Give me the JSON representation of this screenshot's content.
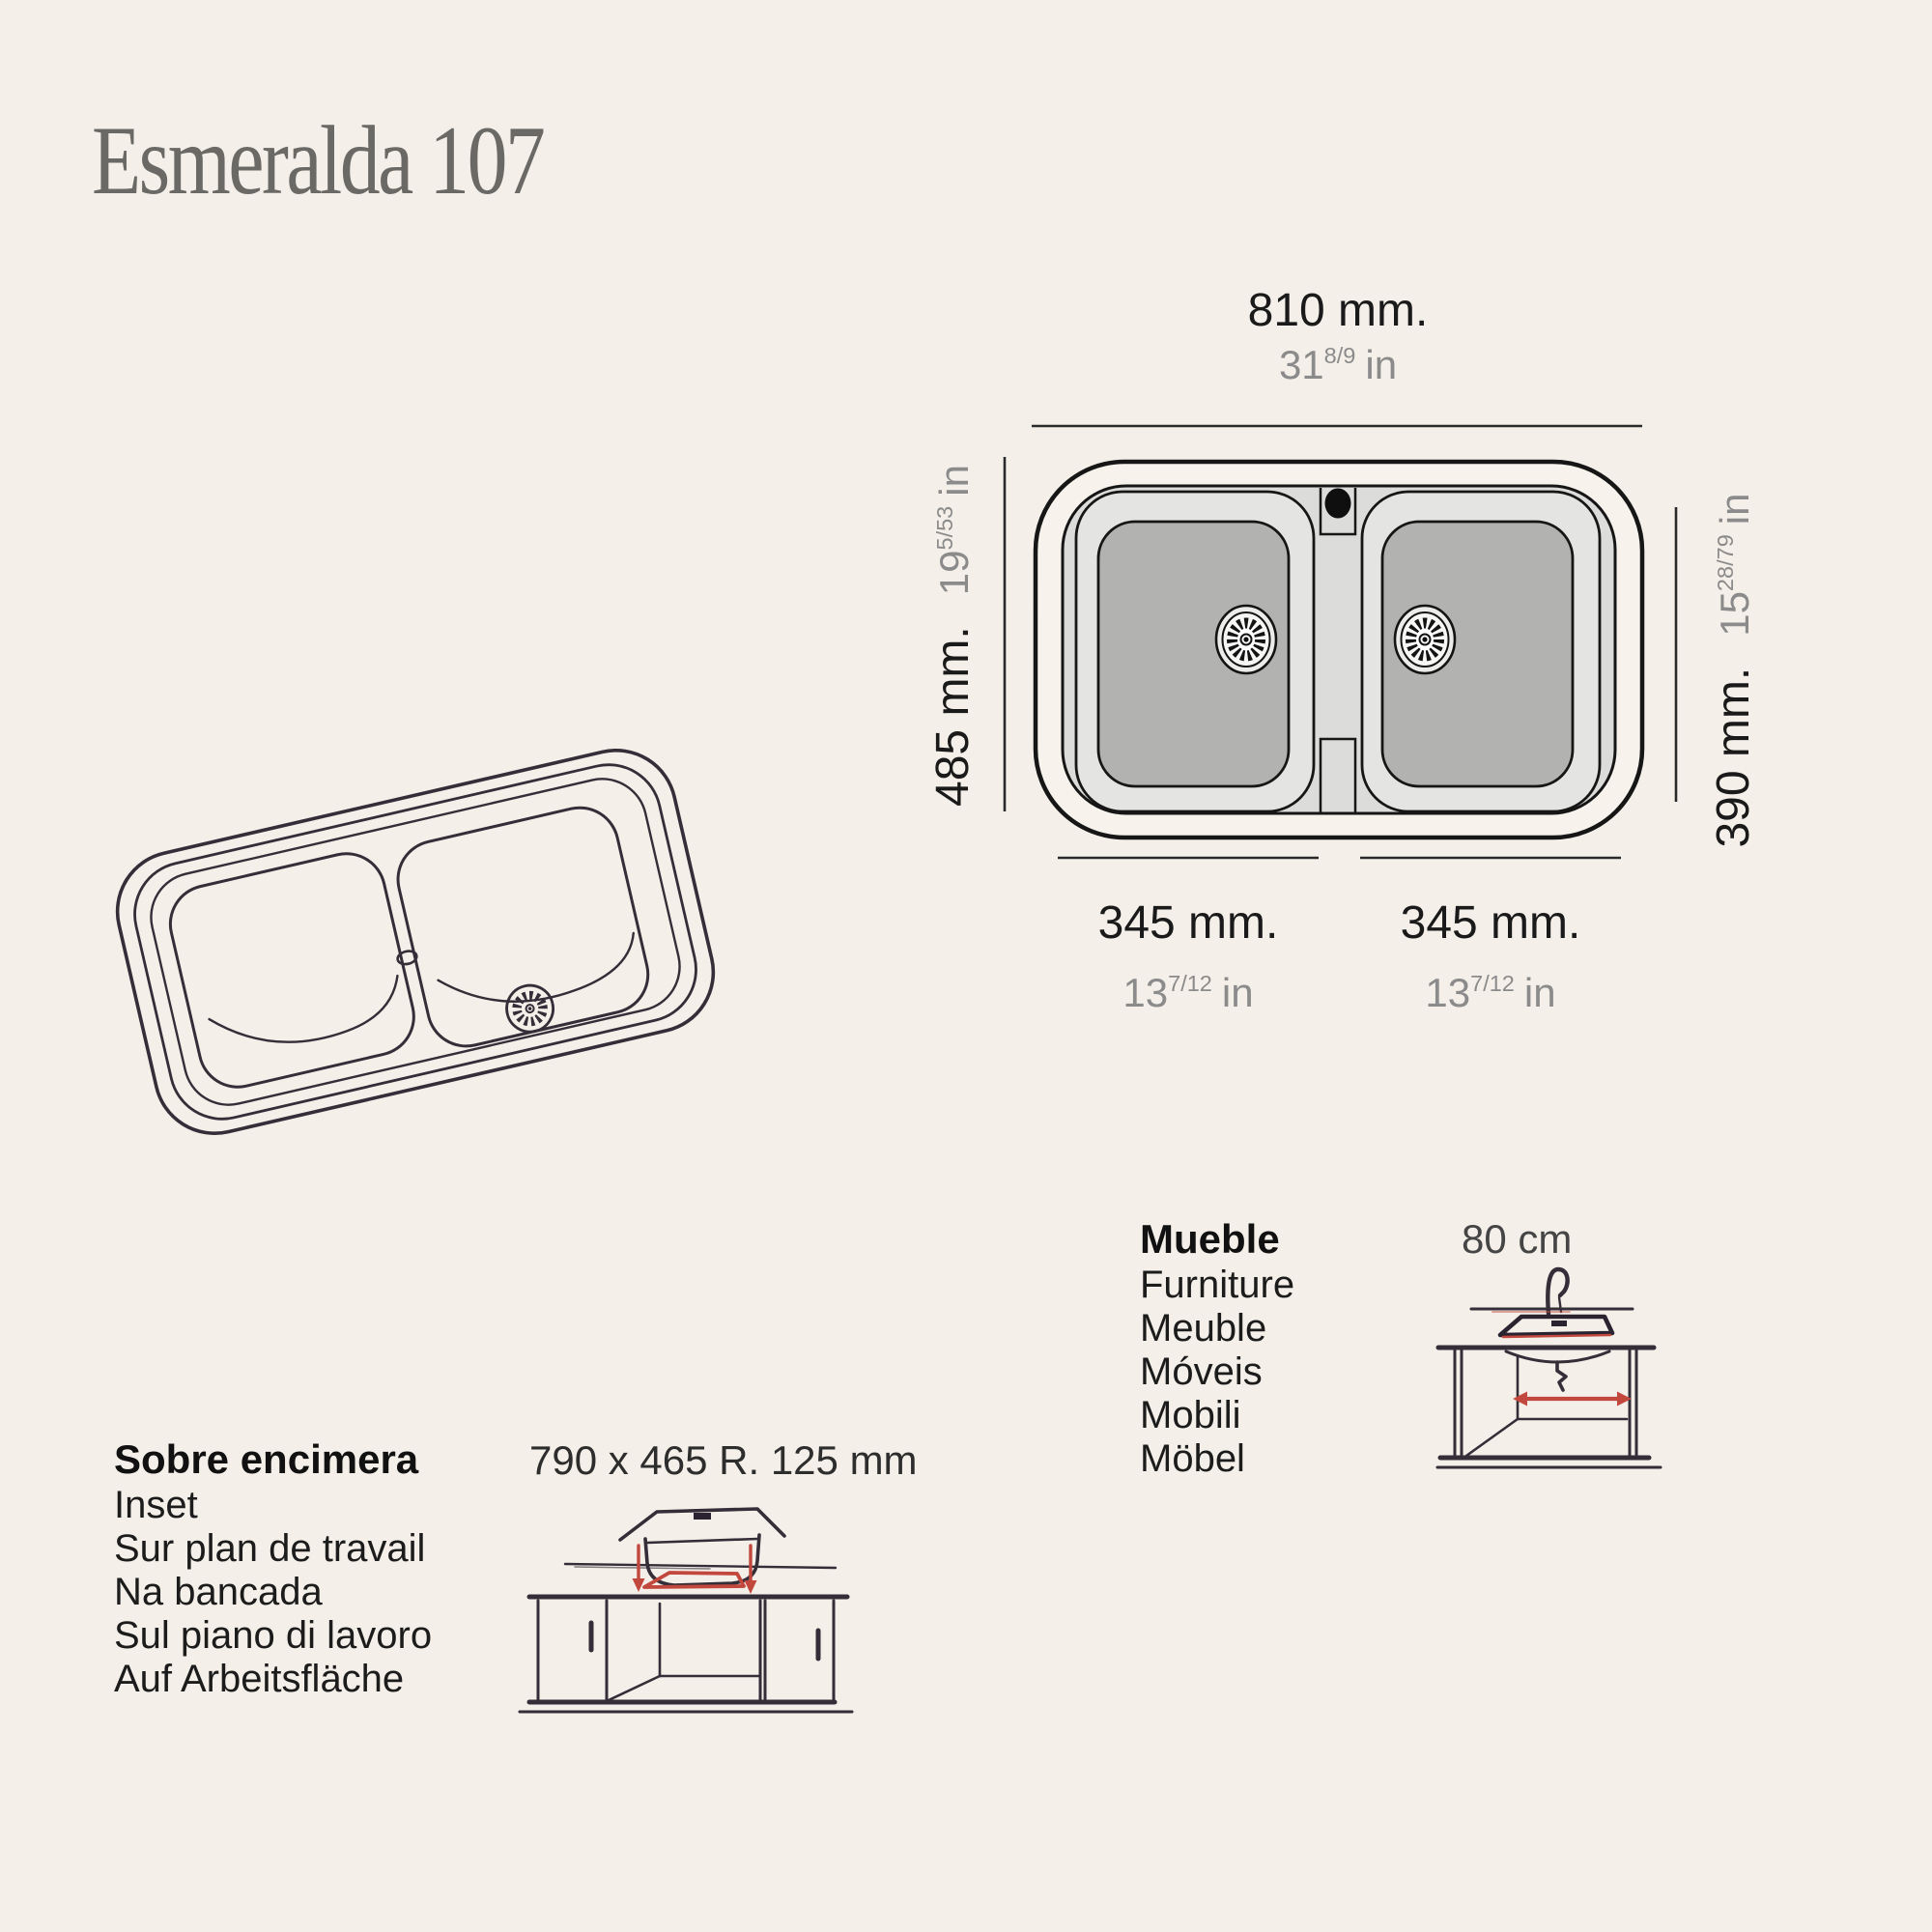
{
  "title": "Esmeralda 107",
  "dimensions": {
    "overall_width": {
      "mm": "810 mm.",
      "inches_int": "31",
      "inches_frac": "8/9",
      "inches_unit": "in"
    },
    "overall_depth": {
      "mm": "485 mm.",
      "inches_int": "19",
      "inches_frac": "5/53",
      "inches_unit": "in"
    },
    "bowl_depth": {
      "mm": "390 mm.",
      "inches_int": "15",
      "inches_frac": "28/79",
      "inches_unit": "in"
    },
    "left_bowl_width": {
      "mm": "345 mm.",
      "inches_int": "13",
      "inches_frac": "7/12",
      "inches_unit": "in"
    },
    "right_bowl_width": {
      "mm": "345 mm.",
      "inches_int": "13",
      "inches_frac": "7/12",
      "inches_unit": "in"
    }
  },
  "inset_installation": {
    "heading": "Sobre encimera",
    "translations": [
      "Inset",
      "Sur plan de travail",
      "Na bancada",
      "Sul piano di lavoro",
      "Auf Arbeitsfläche"
    ],
    "cutout_dimension": "790 x 465 R. 125 mm"
  },
  "furniture": {
    "heading": "Mueble",
    "translations": [
      "Furniture",
      "Meuble",
      "Móveis",
      "Mobili",
      "Möbel"
    ],
    "min_cabinet_width": "80 cm"
  },
  "colors": {
    "background": "#f4efe8",
    "ink": "#1a1a1a",
    "secondary_text": "#8b8b8b",
    "title_gray": "#6b6965",
    "sketch_ink": "#332e38",
    "accent_red": "#c2473c",
    "deck_gray": "#dcdcda",
    "bowl_gray": "#b2b2b0"
  }
}
